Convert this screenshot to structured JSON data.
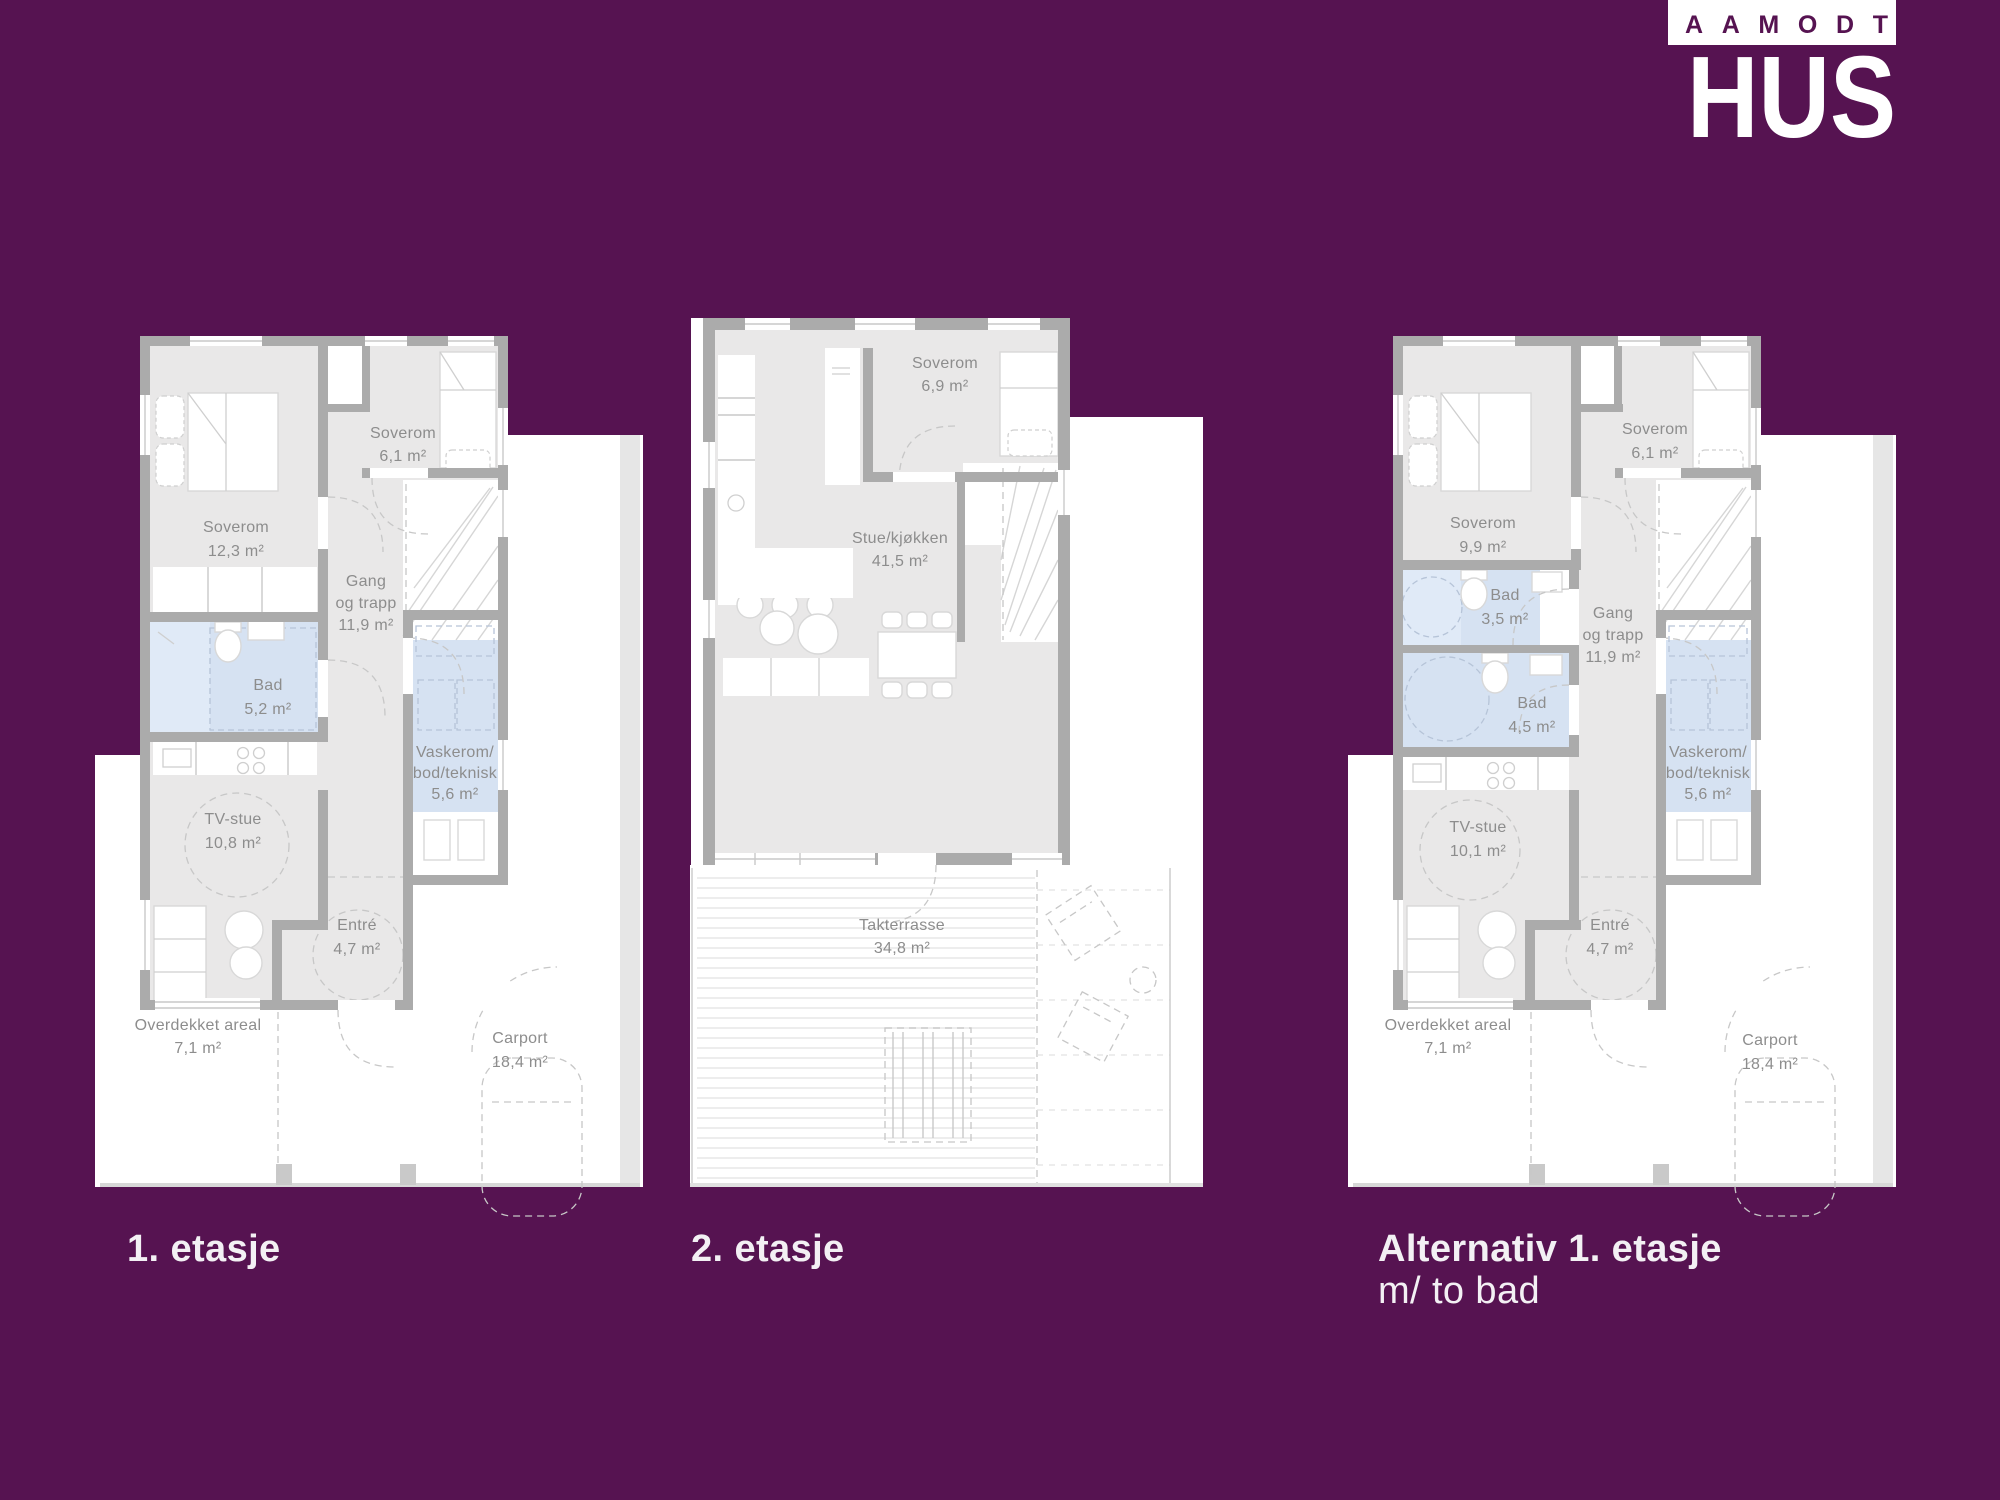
{
  "colors": {
    "background": "#561351",
    "floor": "#e9e8e8",
    "wall": "#ababab",
    "wet_room": "#d6e2f2",
    "label_text": "#8d8d8d",
    "caption_text": "#f3f0f4",
    "logo_white": "#ffffff"
  },
  "logo": {
    "top": "AAMODT",
    "main": "HUS"
  },
  "plans": [
    {
      "caption": "1. etasje",
      "rooms": [
        {
          "name": "Soverom",
          "area": "12,3 m²"
        },
        {
          "name": "Soverom",
          "area": "6,1 m²"
        },
        {
          "name": "Gang",
          "name2": "og trapp",
          "area": "11,9 m²"
        },
        {
          "name": "Bad",
          "area": "5,2 m²"
        },
        {
          "name": "Vaskerom/",
          "name2": "bod/teknisk",
          "area": "5,6 m²"
        },
        {
          "name": "TV-stue",
          "area": "10,8 m²"
        },
        {
          "name": "Entré",
          "area": "4,7 m²"
        },
        {
          "name": "Overdekket areal",
          "area": "7,1 m²"
        },
        {
          "name": "Carport",
          "area": "18,4 m²"
        }
      ]
    },
    {
      "caption": "2. etasje",
      "rooms": [
        {
          "name": "Soverom",
          "area": "6,9 m²"
        },
        {
          "name": "Stue/kjøkken",
          "area": "41,5 m²"
        },
        {
          "name": "Takterrasse",
          "area": "34,8 m²"
        }
      ]
    },
    {
      "caption": "Alternativ 1. etasje",
      "caption2": "m/ to bad",
      "rooms": [
        {
          "name": "Soverom",
          "area": "9,9 m²"
        },
        {
          "name": "Soverom",
          "area": "6,1 m²"
        },
        {
          "name": "Bad",
          "area": "3,5 m²"
        },
        {
          "name": "Gang",
          "name2": "og trapp",
          "area": "11,9 m²"
        },
        {
          "name": "Bad",
          "area": "4,5 m²"
        },
        {
          "name": "Vaskerom/",
          "name2": "bod/teknisk",
          "area": "5,6 m²"
        },
        {
          "name": "TV-stue",
          "area": "10,1 m²"
        },
        {
          "name": "Entré",
          "area": "4,7 m²"
        },
        {
          "name": "Overdekket areal",
          "area": "7,1 m²"
        },
        {
          "name": "Carport",
          "area": "18,4 m²"
        }
      ]
    }
  ]
}
